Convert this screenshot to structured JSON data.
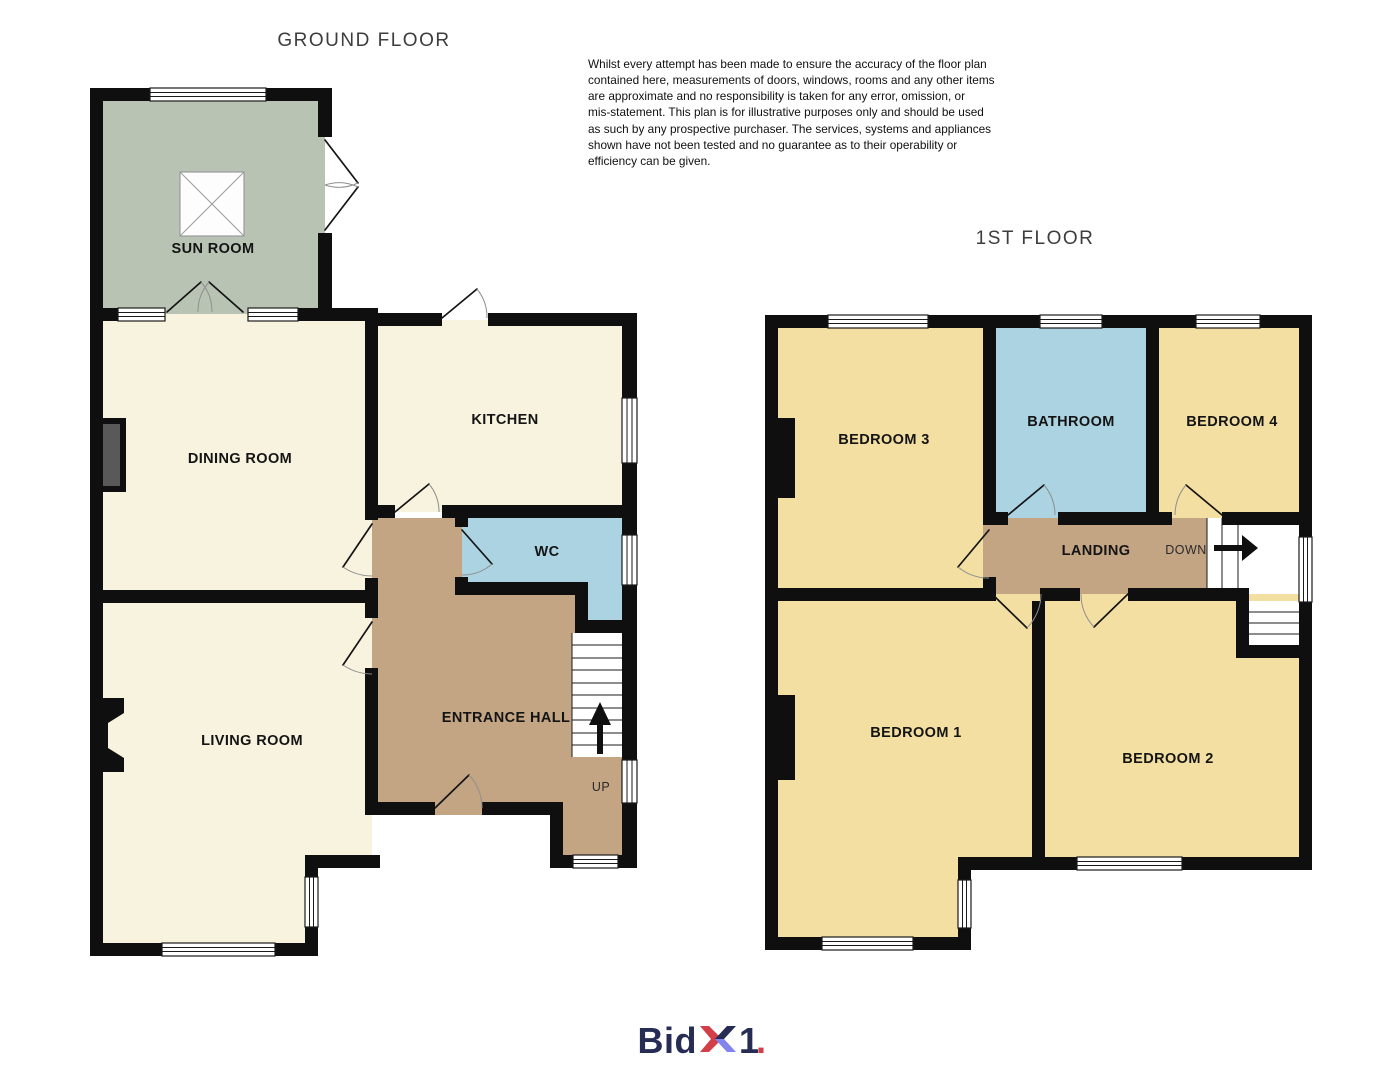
{
  "titles": {
    "ground_floor": "GROUND FLOOR",
    "first_floor": "1ST FLOOR"
  },
  "disclaimer": {
    "lines": [
      "Whilst every attempt has been made to ensure the accuracy of the floor plan",
      "contained here, measurements of doors, windows, rooms and any other items",
      "are approximate and no responsibility is taken for any error, omission, or",
      "mis-statement. This plan is for illustrative purposes only and should be used",
      "as such by any prospective purchaser. The services, systems and appliances",
      "shown have not been tested and no guarantee as to their operability or",
      "efficiency can be given."
    ]
  },
  "ground_floor": {
    "rooms": {
      "sun_room": "SUN ROOM",
      "dining_room": "DINING ROOM",
      "kitchen": "KITCHEN",
      "wc": "WC",
      "entrance_hall": "ENTRANCE HALL",
      "living_room": "LIVING ROOM"
    },
    "stair_direction": "UP"
  },
  "first_floor": {
    "rooms": {
      "bedroom_3": "BEDROOM 3",
      "bathroom": "BATHROOM",
      "bedroom_4": "BEDROOM 4",
      "landing": "LANDING",
      "bedroom_1": "BEDROOM 1",
      "bedroom_2": "BEDROOM 2"
    },
    "stair_direction": "DOWN"
  },
  "logo": {
    "bid": "Bid",
    "one": "1",
    "dot": "."
  },
  "colors": {
    "wall": "#0f0f0f",
    "room_cream": "#f8f3de",
    "room_sage": "#b9c3b3",
    "room_yellow": "#f3dfa2",
    "room_blue": "#abd3e2",
    "room_tan": "#c3a584",
    "chimney_gray": "#595959",
    "logo_navy": "#272c55",
    "logo_red": "#d23f48",
    "logo_periwinkle": "#8183ef"
  }
}
